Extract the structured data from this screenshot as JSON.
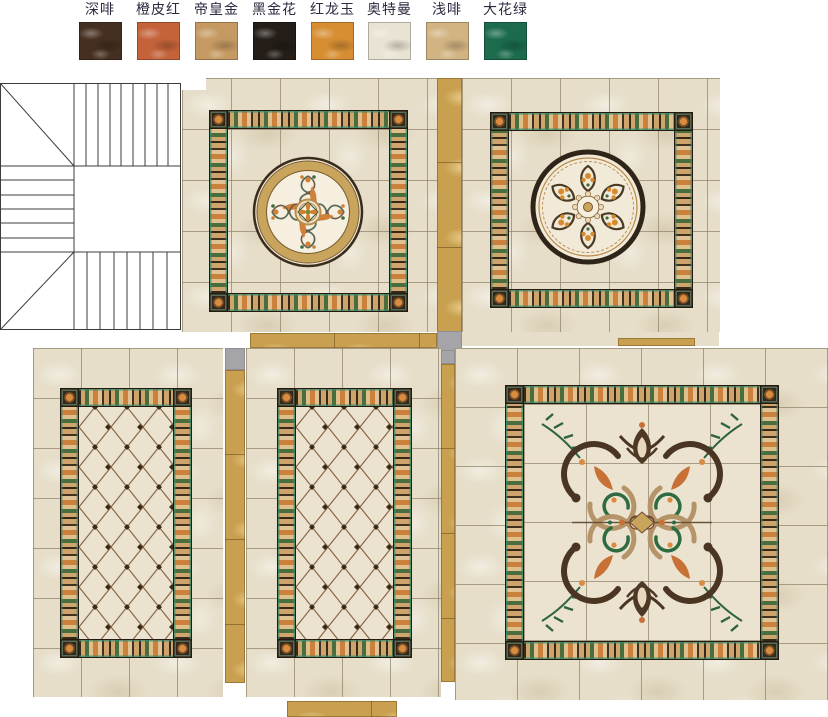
{
  "legend": {
    "items": [
      {
        "label": "深啡",
        "color": "#452f20"
      },
      {
        "label": "橙皮红",
        "color": "#c4633a"
      },
      {
        "label": "帝皇金",
        "color": "#c59a62"
      },
      {
        "label": "黑金花",
        "color": "#241d18"
      },
      {
        "label": "红龙玉",
        "color": "#d78e33"
      },
      {
        "label": "奥特曼",
        "color": "#e9e3d3"
      },
      {
        "label": "浅啡",
        "color": "#d2b483"
      },
      {
        "label": "大花绿",
        "color": "#1b6b4c"
      }
    ]
  },
  "palette": {
    "tile_cream": "#e6dec9",
    "gold_strip": "#c8a050",
    "gray_inset": "#a5a5a9",
    "frame_dark": "#2f2416",
    "frame_green": "#386638",
    "frame_orange": "#cb7e38",
    "medallion_gold": "#c9a45c",
    "lattice_line": "#8a6848",
    "stair_line": "#3c3c3c"
  }
}
